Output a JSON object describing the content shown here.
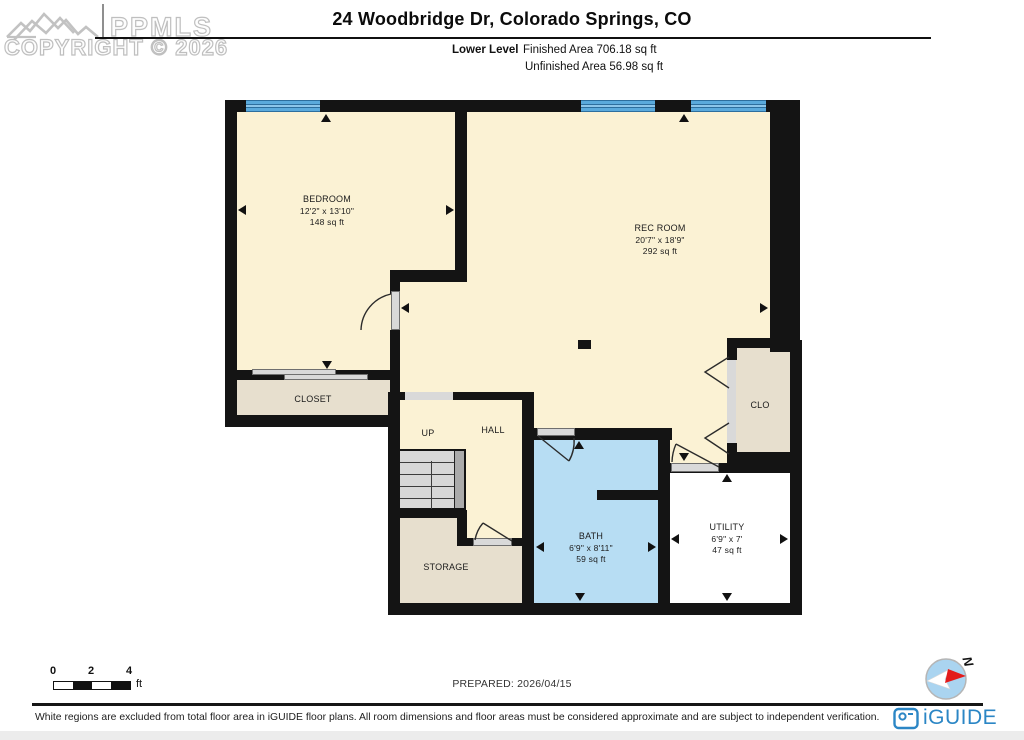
{
  "header": {
    "title": "24 Woodbridge Dr, Colorado Springs, CO",
    "level_label": "Lower Level",
    "finished_area": "Finished Area 706.18 sq ft",
    "unfinished_area": "Unfinished Area 56.98 sq ft",
    "watermark": {
      "brand": "PPMLS",
      "copyright": "COPYRIGHT © 2026"
    }
  },
  "rooms": {
    "bedroom": {
      "name": "BEDROOM",
      "dims": "12'2\" x 13'10\"",
      "area": "148 sq ft"
    },
    "rec_room": {
      "name": "REC ROOM",
      "dims": "20'7\" x 18'9\"",
      "area": "292 sq ft"
    },
    "closet": {
      "name": "CLOSET"
    },
    "up": {
      "name": "UP"
    },
    "hall": {
      "name": "HALL"
    },
    "storage": {
      "name": "STORAGE"
    },
    "bath": {
      "name": "BATH",
      "dims": "6'9\" x 8'11\"",
      "area": "59 sq ft"
    },
    "utility": {
      "name": "UTILITY",
      "dims": "6'9\" x 7'",
      "area": "47 sq ft"
    },
    "clo": {
      "name": "CLO"
    }
  },
  "scale_bar": {
    "ticks": [
      "0",
      "2",
      "4"
    ],
    "unit": "ft"
  },
  "footer": {
    "prepared": "PREPARED: 2026/04/15",
    "compass_label": "N",
    "disclaimer": "White regions are excluded from total floor area in iGUIDE floor plans. All room dimensions and floor areas must be considered approximate and are subject to independent verification.",
    "brand": "iGUIDE"
  },
  "colors": {
    "wall": "#141414",
    "finished_floor": "#fbf2d4",
    "unfinished_floor_tan": "#e7dfce",
    "bath_floor": "#b7ddf3",
    "utility_floor": "#ffffff",
    "window_blue": "#58a8da",
    "door_gray": "#d9d9d9",
    "stairs_gray": "#d8d8d8",
    "brand_blue": "#2b86c5",
    "north_red": "#e31b1b",
    "watermark_gray": "#c0c0c0"
  }
}
